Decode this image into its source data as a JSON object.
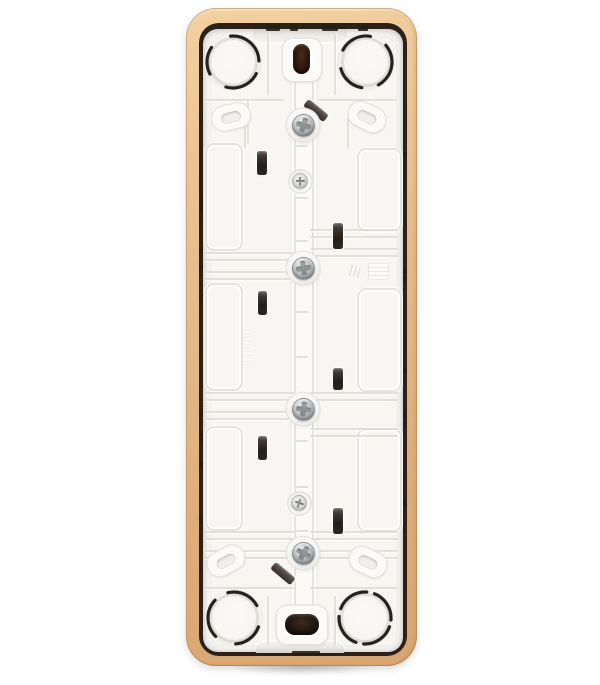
{
  "scene": {
    "type": "product-photo",
    "subject": "Rear side of a white plastic wall-switch mounting plate with a beige-gold outer frame",
    "orientation": "vertical",
    "background": "#ffffff"
  },
  "palette": {
    "gold_hi": "#f2d1a2",
    "gold": "#e6b988",
    "gold_dk": "#d8a672",
    "seam": "#2c2119",
    "base": "#f7f6f3",
    "raised": "#fbfaf7",
    "groove": "#e6e3de",
    "groove_dk": "#dcd8d1",
    "slot": "#241e19",
    "steel_hi": "#eceeee",
    "steel": "#c0c4c6",
    "steel_dk": "#8f9396",
    "steel_recess": "#7c8083",
    "small_head": "#d9dbd9",
    "pill": "#1d0f07"
  },
  "counts": {
    "knockout_circles": 4,
    "large_screws": 4,
    "small_screws": 2,
    "vertical_claw_slots": 6,
    "diagonal_claw_slots": 2,
    "oval_bosses": 4,
    "module_panels": 6
  },
  "features": {
    "knockouts": [
      {
        "x": 233,
        "y": 62,
        "rot": -95,
        "dash": "42 13 36 21 28 23"
      },
      {
        "x": 366,
        "y": 62,
        "rot": -40,
        "dash": "46 17 30 19 33 18"
      },
      {
        "x": 234,
        "y": 618,
        "rot": 135,
        "dash": "40 15 34 22 30 22"
      },
      {
        "x": 365,
        "y": 618,
        "rot": 20,
        "dash": "33 8 33 8 33 8 33 7"
      }
    ],
    "ovals": [
      {
        "x": 231,
        "y": 117,
        "rot": -14
      },
      {
        "x": 367,
        "y": 117,
        "rot": 25
      },
      {
        "x": 226,
        "y": 561,
        "rot": -28
      },
      {
        "x": 368,
        "y": 562,
        "rot": 25
      }
    ],
    "screws_large": [
      {
        "x": 303,
        "y": 125,
        "rot": 18
      },
      {
        "x": 303,
        "y": 268,
        "rot": -8
      },
      {
        "x": 303,
        "y": 409,
        "rot": 8
      },
      {
        "x": 303,
        "y": 553,
        "rot": 30
      }
    ],
    "screws_small": [
      {
        "x": 300,
        "y": 181,
        "rot": 0
      },
      {
        "x": 299,
        "y": 503,
        "rot": 18
      }
    ],
    "slots_vertical": [
      {
        "x": 262,
        "y": 163,
        "w": 10,
        "h": 24
      },
      {
        "x": 338,
        "y": 236,
        "w": 10,
        "h": 26
      },
      {
        "x": 262,
        "y": 303,
        "w": 9,
        "h": 24
      },
      {
        "x": 338,
        "y": 379,
        "w": 10,
        "h": 22
      },
      {
        "x": 262,
        "y": 448,
        "w": 9,
        "h": 24
      },
      {
        "x": 338,
        "y": 521,
        "w": 10,
        "h": 26
      }
    ],
    "slots_diagonal": [
      {
        "x": 316,
        "y": 110,
        "w": 26,
        "h": 9,
        "rot": 39
      },
      {
        "x": 283,
        "y": 573,
        "w": 26,
        "h": 9,
        "rot": 40
      }
    ],
    "panels": [
      {
        "x": 205,
        "y": 143,
        "w": 34,
        "h": 104
      },
      {
        "x": 205,
        "y": 283,
        "w": 34,
        "h": 104
      },
      {
        "x": 205,
        "y": 426,
        "w": 34,
        "h": 101
      },
      {
        "x": 357,
        "y": 148,
        "w": 41,
        "h": 80
      },
      {
        "x": 357,
        "y": 288,
        "w": 41,
        "h": 100
      },
      {
        "x": 357,
        "y": 428,
        "w": 41,
        "h": 100
      }
    ],
    "ridge_h": [
      [
        205,
        99,
        79
      ],
      [
        205,
        252,
        89
      ],
      [
        205,
        259,
        89
      ],
      [
        205,
        271,
        89
      ],
      [
        205,
        278,
        89
      ],
      [
        205,
        392,
        89
      ],
      [
        205,
        399,
        89
      ],
      [
        205,
        411,
        89
      ],
      [
        205,
        418,
        89
      ],
      [
        205,
        531,
        89
      ],
      [
        205,
        538,
        89
      ],
      [
        205,
        550,
        89
      ],
      [
        205,
        557,
        89
      ],
      [
        205,
        587,
        89
      ],
      [
        318,
        99,
        79
      ],
      [
        310,
        229,
        88
      ],
      [
        310,
        236,
        88
      ],
      [
        310,
        248,
        88
      ],
      [
        310,
        255,
        88
      ],
      [
        310,
        392,
        88
      ],
      [
        310,
        399,
        88
      ],
      [
        310,
        428,
        88
      ],
      [
        310,
        435,
        88
      ],
      [
        310,
        531,
        88
      ],
      [
        310,
        538,
        88
      ],
      [
        310,
        550,
        88
      ],
      [
        310,
        557,
        88
      ],
      [
        310,
        587,
        88
      ]
    ],
    "ridge_v": [
      [
        267,
        33,
        62
      ],
      [
        334,
        33,
        62
      ],
      [
        247,
        99,
        45
      ],
      [
        347,
        118,
        31
      ],
      [
        244,
        108,
        40
      ],
      [
        267,
        596,
        49
      ],
      [
        334,
        596,
        49
      ]
    ],
    "rail_ticks": [
      145,
      197,
      240,
      311,
      356,
      440,
      486,
      530
    ],
    "seam_notches": [
      [
        199,
        113,
        4,
        8
      ],
      [
        199,
        199,
        4,
        13
      ],
      [
        199,
        248,
        4,
        6
      ],
      [
        199,
        264,
        4,
        8
      ],
      [
        199,
        294,
        4,
        7
      ],
      [
        199,
        408,
        4,
        8
      ],
      [
        199,
        433,
        4,
        8
      ],
      [
        199,
        462,
        4,
        6
      ],
      [
        199,
        515,
        4,
        8
      ],
      [
        403,
        152,
        4,
        6
      ],
      [
        403,
        267,
        4,
        7
      ],
      [
        403,
        276,
        4,
        6
      ],
      [
        403,
        368,
        4,
        5
      ],
      [
        403,
        410,
        4,
        8
      ],
      [
        403,
        421,
        4,
        6
      ],
      [
        403,
        500,
        4,
        7
      ],
      [
        266,
        26,
        14,
        5
      ],
      [
        290,
        26,
        8,
        5
      ],
      [
        322,
        26,
        16,
        5
      ],
      [
        358,
        26,
        10,
        5
      ],
      [
        292,
        651,
        28,
        4
      ]
    ],
    "embossed_rect": {
      "x": 368,
      "y": 263,
      "w": 19,
      "h": 15
    },
    "embossed_ticks": [
      {
        "x": 350,
        "y": 265
      },
      {
        "x": 354,
        "y": 266
      },
      {
        "x": 358,
        "y": 267
      }
    ],
    "embossed_zipper": {
      "x": 243,
      "y": 330,
      "w": 8,
      "h": 37
    }
  }
}
